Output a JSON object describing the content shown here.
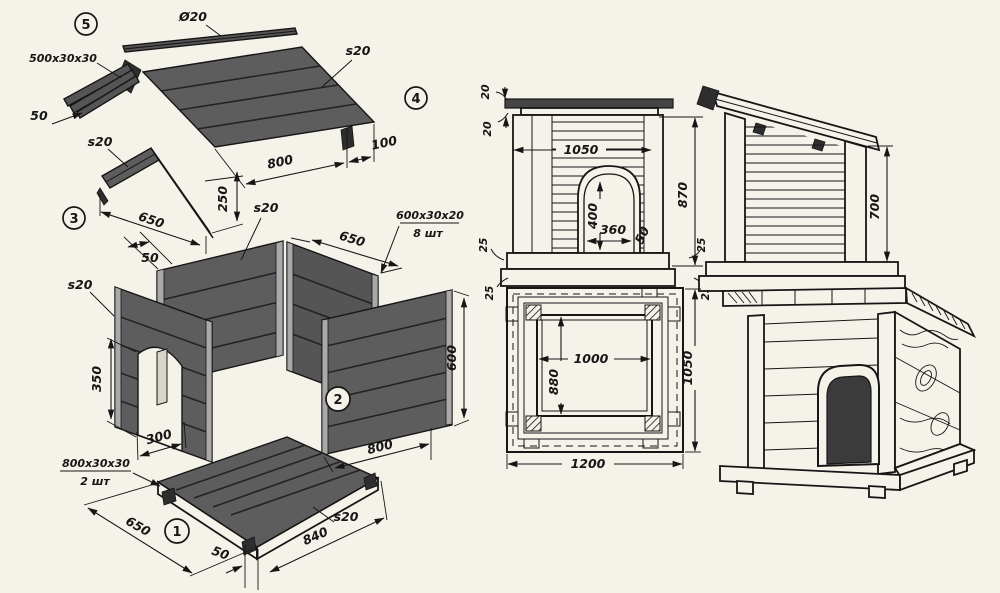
{
  "drawing_title": "Doghouse construction drawing",
  "colors": {
    "paper": "#f5f2e9",
    "ink": "#161616",
    "wood_panel": "#5d5d5d",
    "dark_detail": "#2e2e2e"
  },
  "parts": {
    "p1": "1",
    "p2": "2",
    "p3": "3",
    "p4": "4",
    "p5": "5"
  },
  "exploded": {
    "ridge_pole_dia": "Ø20",
    "ridge_bar_size": "500x30x30",
    "roof_s20": "s20",
    "roof_800": "800",
    "roof_100": "100",
    "gable_50": "50",
    "part3_s20": "s20",
    "part3_650": "650",
    "part3_250": "250",
    "back_s20": "s20",
    "back_650": "650",
    "batten_size": "600x30x20",
    "batten_qty": "8 шт",
    "post_50": "50",
    "front_s20": "s20",
    "door_350": "350",
    "door_300": "300",
    "side_600": "600",
    "side_800": "800",
    "skid_size": "800x30x30",
    "skid_qty": "2 шт",
    "base_650": "650",
    "base_50": "50",
    "base_840": "840",
    "base_s20": "s20"
  },
  "front_view": {
    "roof_20": "20",
    "trim_20": "20",
    "width_1050": "1050",
    "door_400": "400",
    "door_360": "360",
    "trim_50": "50",
    "left_25a": "25",
    "left_25b": "25",
    "height_870": "870",
    "right_25a": "25",
    "right_25b": "25"
  },
  "side_view": {
    "height_700": "700"
  },
  "plan_view": {
    "inner_1000": "1000",
    "inner_880": "880",
    "outer_1200": "1200",
    "outer_1050": "1050"
  }
}
